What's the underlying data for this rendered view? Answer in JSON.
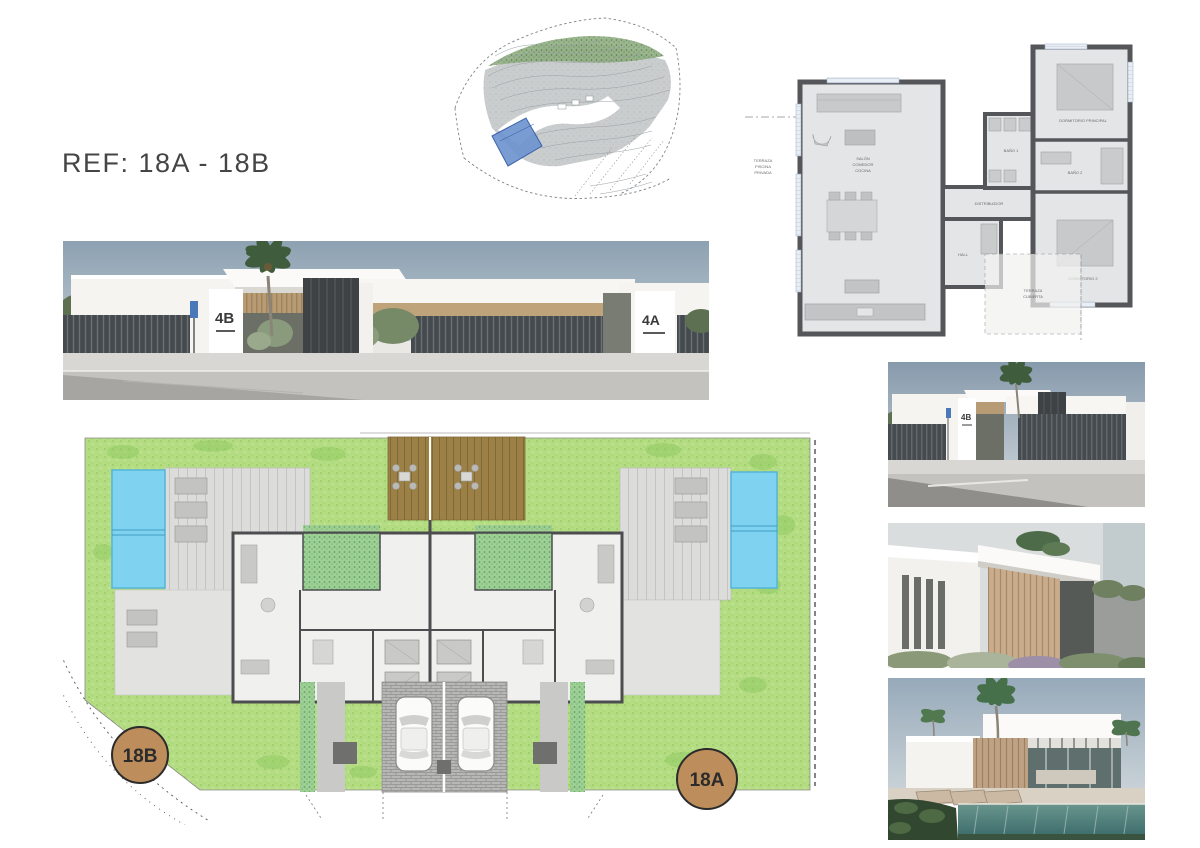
{
  "page": {
    "background": "#ffffff",
    "ref_label": "REF: 18A - 18B"
  },
  "topo_map": {
    "plot_highlight_color": "#6e95cf"
  },
  "floor_plan": {
    "wall_color": "#54565a",
    "room_fill": "#e4e5e7",
    "labels": {
      "living_1": "SALÓN",
      "living_2": "COMEDOR",
      "living_3": "COCINA",
      "master_bedroom": "DORMITORIO PRINCIPAL",
      "bath1": "BAÑO 1",
      "bath2": "BAÑO 2",
      "bedroom2": "DORMITORIO 2",
      "hall": "HALL",
      "distributor": "DISTRIBUIDOR",
      "terrace_1": "TERRAZA",
      "terrace_2": "CUBIERTA",
      "side_note_1": "TERRAZA",
      "side_note_2": "PISCINA",
      "side_note_3": "PRIVADA"
    }
  },
  "street_elevation": {
    "house_left_label": "4B",
    "house_right_label": "4A",
    "sky_color": "#8fa2b4"
  },
  "site_plan": {
    "plot_left_label": "18B",
    "plot_right_label": "18A",
    "badge_fill": "#bd8e5b",
    "badge_border": "#2b2b2b",
    "lawn_color": "#b4dc82",
    "pool_color": "#7fd3f1",
    "deck_color": "#9c8045"
  },
  "right_renders": {
    "render_1": {
      "house_number": "4B"
    }
  }
}
